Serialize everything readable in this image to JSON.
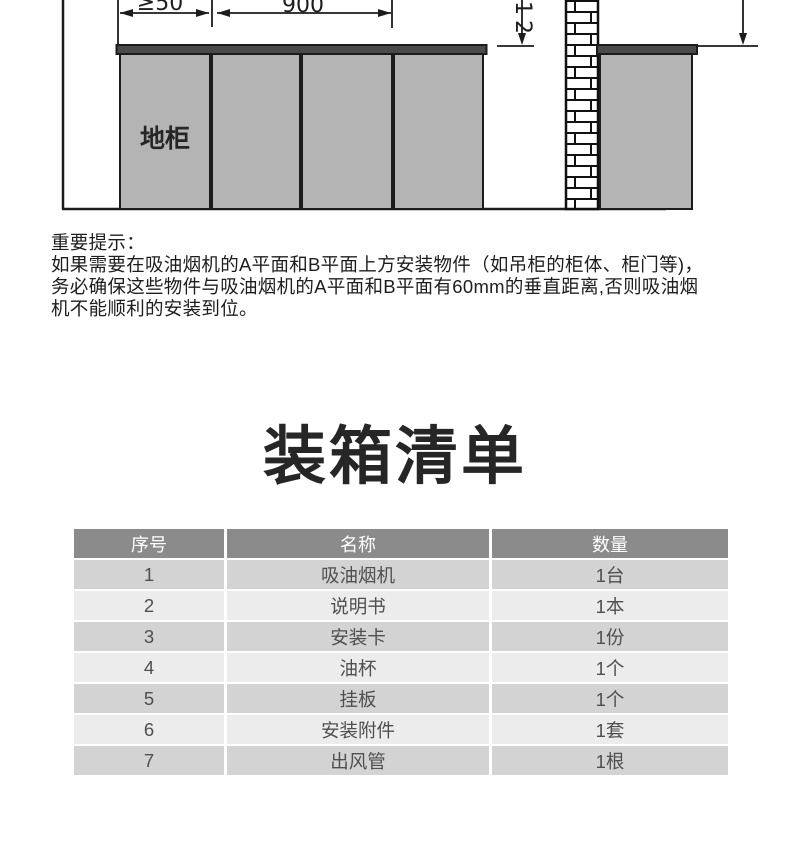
{
  "diagram": {
    "labels": {
      "gap_dim": "≥50",
      "width_dim": "900",
      "height_dim": "12",
      "base_cabinet": "地柜"
    },
    "colors": {
      "cabinet_fill": "#b4b4b4",
      "countertop_fill": "#4a4a4a",
      "line": "#1c1c1c",
      "brick_bg": "#ffffff"
    }
  },
  "notice": {
    "title": "重要提示：",
    "lines": [
      "如果需要在吸油烟机的A平面和B平面上方安装物件（如吊柜的柜体、柜门等)，",
      "务必确保这些物件与吸油烟机的A平面和B平面有60mm的垂直距离,否则吸油烟",
      "机不能顺利的安装到位。"
    ]
  },
  "packing_list": {
    "title": "装箱清单",
    "columns": [
      "序号",
      "名称",
      "数量"
    ],
    "rows": [
      {
        "no": "1",
        "name": "吸油烟机",
        "qty": "1台"
      },
      {
        "no": "2",
        "name": "说明书",
        "qty": "1本"
      },
      {
        "no": "3",
        "name": "安装卡",
        "qty": "1份"
      },
      {
        "no": "4",
        "name": "油杯",
        "qty": "1个"
      },
      {
        "no": "5",
        "name": "挂板",
        "qty": "1个"
      },
      {
        "no": "6",
        "name": "安装附件",
        "qty": "1套"
      },
      {
        "no": "7",
        "name": "出风管",
        "qty": "1根"
      }
    ],
    "colors": {
      "header_bg": "#8b8b8b",
      "header_text": "#ffffff",
      "row_odd_bg": "#d3d3d3",
      "row_even_bg": "#ececec",
      "cell_text": "#4f4f4f"
    }
  }
}
